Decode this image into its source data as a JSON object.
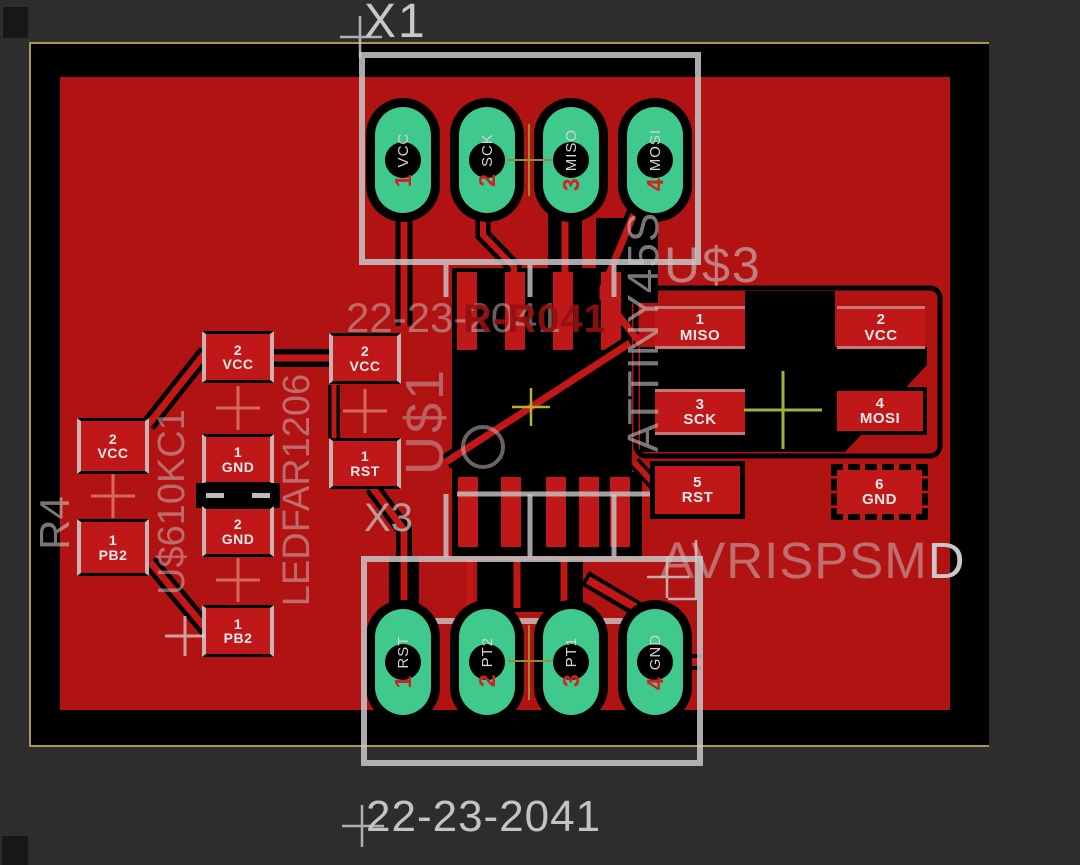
{
  "silkscreen": {
    "x1": "X1",
    "x3": "X3",
    "value_top": "22-23-2041",
    "value_bottom": "22-23-2041",
    "r_array": "R-R041",
    "u1": "U$1",
    "u3": "U$3",
    "attiny": "ATTINY45S",
    "avrisp_main": "AVRISPSM",
    "avrisp_tail": "D",
    "r4": "R4",
    "res_net": "U$610KC1",
    "led": "LEDFAR1206"
  },
  "connector_top_pads": [
    {
      "num": "1",
      "name": "VCC"
    },
    {
      "num": "2",
      "name": "SCK"
    },
    {
      "num": "3",
      "name": "MISO"
    },
    {
      "num": "4",
      "name": "MOSI"
    }
  ],
  "connector_bottom_pads": [
    {
      "num": "1",
      "name": "RST"
    },
    {
      "num": "2",
      "name": "PT2"
    },
    {
      "num": "3",
      "name": "PT1"
    },
    {
      "num": "4",
      "name": "GND"
    }
  ],
  "passive_pads": {
    "r4_top": {
      "num": "2",
      "name": "VCC"
    },
    "r4_bottom": {
      "num": "1",
      "name": "PB2"
    },
    "col1": [
      {
        "num": "2",
        "name": "VCC"
      },
      {
        "num": "1",
        "name": "GND"
      },
      {
        "num": "2",
        "name": "GND"
      },
      {
        "num": "1",
        "name": "PB2"
      }
    ],
    "col2": [
      {
        "num": "2",
        "name": "VCC"
      },
      {
        "num": "1",
        "name": "RST"
      }
    ]
  },
  "target_pads": [
    {
      "num": "1",
      "name": "MISO"
    },
    {
      "num": "2",
      "name": "VCC"
    },
    {
      "num": "3",
      "name": "SCK"
    },
    {
      "num": "4",
      "name": "MOSI"
    },
    {
      "num": "5",
      "name": "RST"
    },
    {
      "num": "6",
      "name": "GND"
    }
  ],
  "colors": {
    "copper": "#b11313",
    "pad_red": "#c01818",
    "pad_green": "#3fc98d",
    "silk": "#c8c8c8",
    "frame": "#ab9752"
  }
}
